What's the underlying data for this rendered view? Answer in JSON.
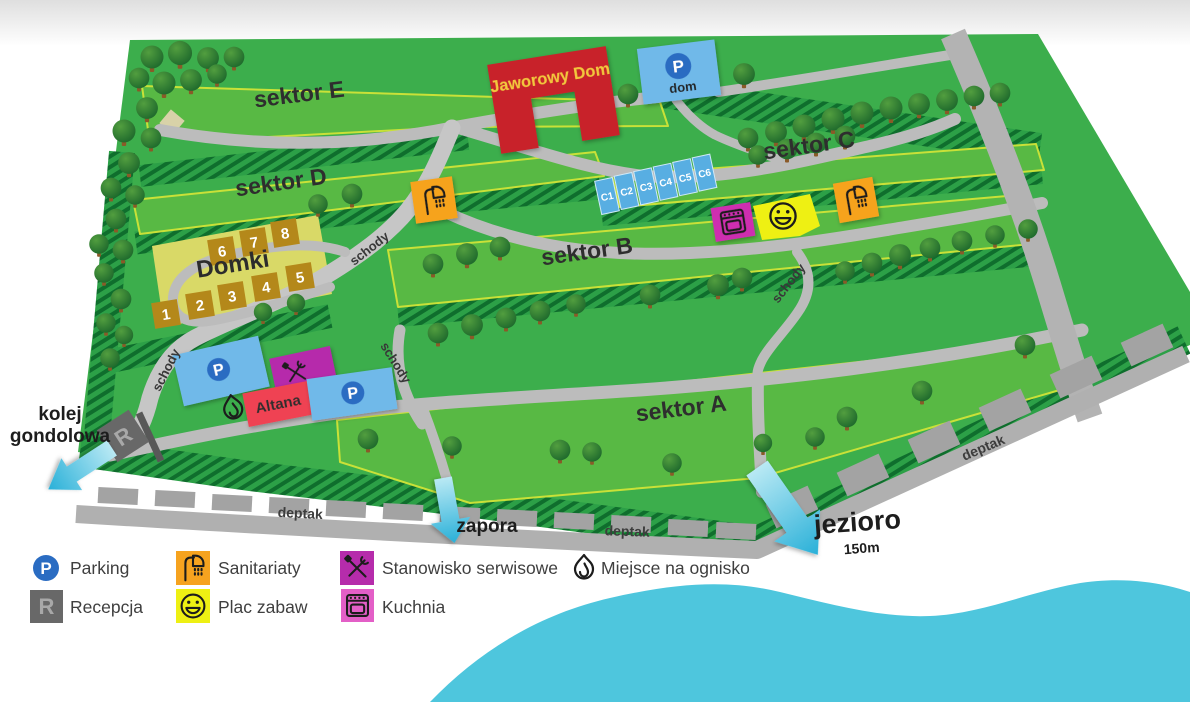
{
  "map": {
    "sector_labels": {
      "a": "sektor A",
      "b": "sektor B",
      "c": "sektor C",
      "d": "sektor D",
      "e": "sektor E"
    },
    "jaworowy_dom": "Jaworowy Dom",
    "parking_dom": {
      "letter": "P",
      "label": "dom"
    },
    "cabins": [
      "C1",
      "C2",
      "C3",
      "C4",
      "C5",
      "C6"
    ],
    "domki": {
      "title": "Domki",
      "numbers": [
        "1",
        "2",
        "3",
        "4",
        "5",
        "6",
        "7",
        "8"
      ]
    },
    "altana": "Altana",
    "parking_letter": "P",
    "reception_letter": "R",
    "schody": "schody",
    "deptak": "deptak",
    "zapora": "zapora",
    "jezioro": {
      "label": "jezioro",
      "distance": "150m"
    },
    "kolej_gondolowa": {
      "line1": "kolej",
      "line2": "gondolowa"
    }
  },
  "legend": {
    "items": [
      {
        "id": "parking",
        "icon": "parking-icon",
        "label": "Parking"
      },
      {
        "id": "recepcja",
        "icon": "reception-icon",
        "label": "Recepcja"
      },
      {
        "id": "sanitariaty",
        "icon": "shower-icon",
        "label": "Sanitariaty"
      },
      {
        "id": "plac-zabaw",
        "icon": "smiley-icon",
        "label": "Plac zabaw"
      },
      {
        "id": "stanowisko-serwisowe",
        "icon": "tools-icon",
        "label": "Stanowisko serwisowe"
      },
      {
        "id": "kuchnia",
        "icon": "oven-icon",
        "label": "Kuchnia"
      },
      {
        "id": "miejsce-na-ognisko",
        "icon": "fire-icon",
        "label": "Miejsce na ognisko"
      }
    ]
  },
  "colors": {
    "grass": "#3cae4c",
    "sector": "#58b944",
    "sector_border": "#c9e138",
    "hatch_dark": "#0f6e2d",
    "path_gray": "#bcbcbc",
    "road_gray": "#b3b3b3",
    "water": "#4ec6dd",
    "parking_blue": "#2a6cc2",
    "parking_box_blue": "#6fb9e9",
    "sanitariaty_orange": "#f6a31f",
    "kuchnia_magenta": "#ce2fb0",
    "kuchnia_legend_pink": "#e35fc7",
    "serwis_magenta": "#b62cab",
    "plac_zabaw_yellow": "#eef013",
    "altana_red": "#ef4353",
    "jaworowy_red": "#c8232c",
    "domki_area_yellow": "#d9d967",
    "domki_box_brown": "#b4881a",
    "reception_gray": "#686868",
    "arrow_cyan": "#29b0d8"
  }
}
